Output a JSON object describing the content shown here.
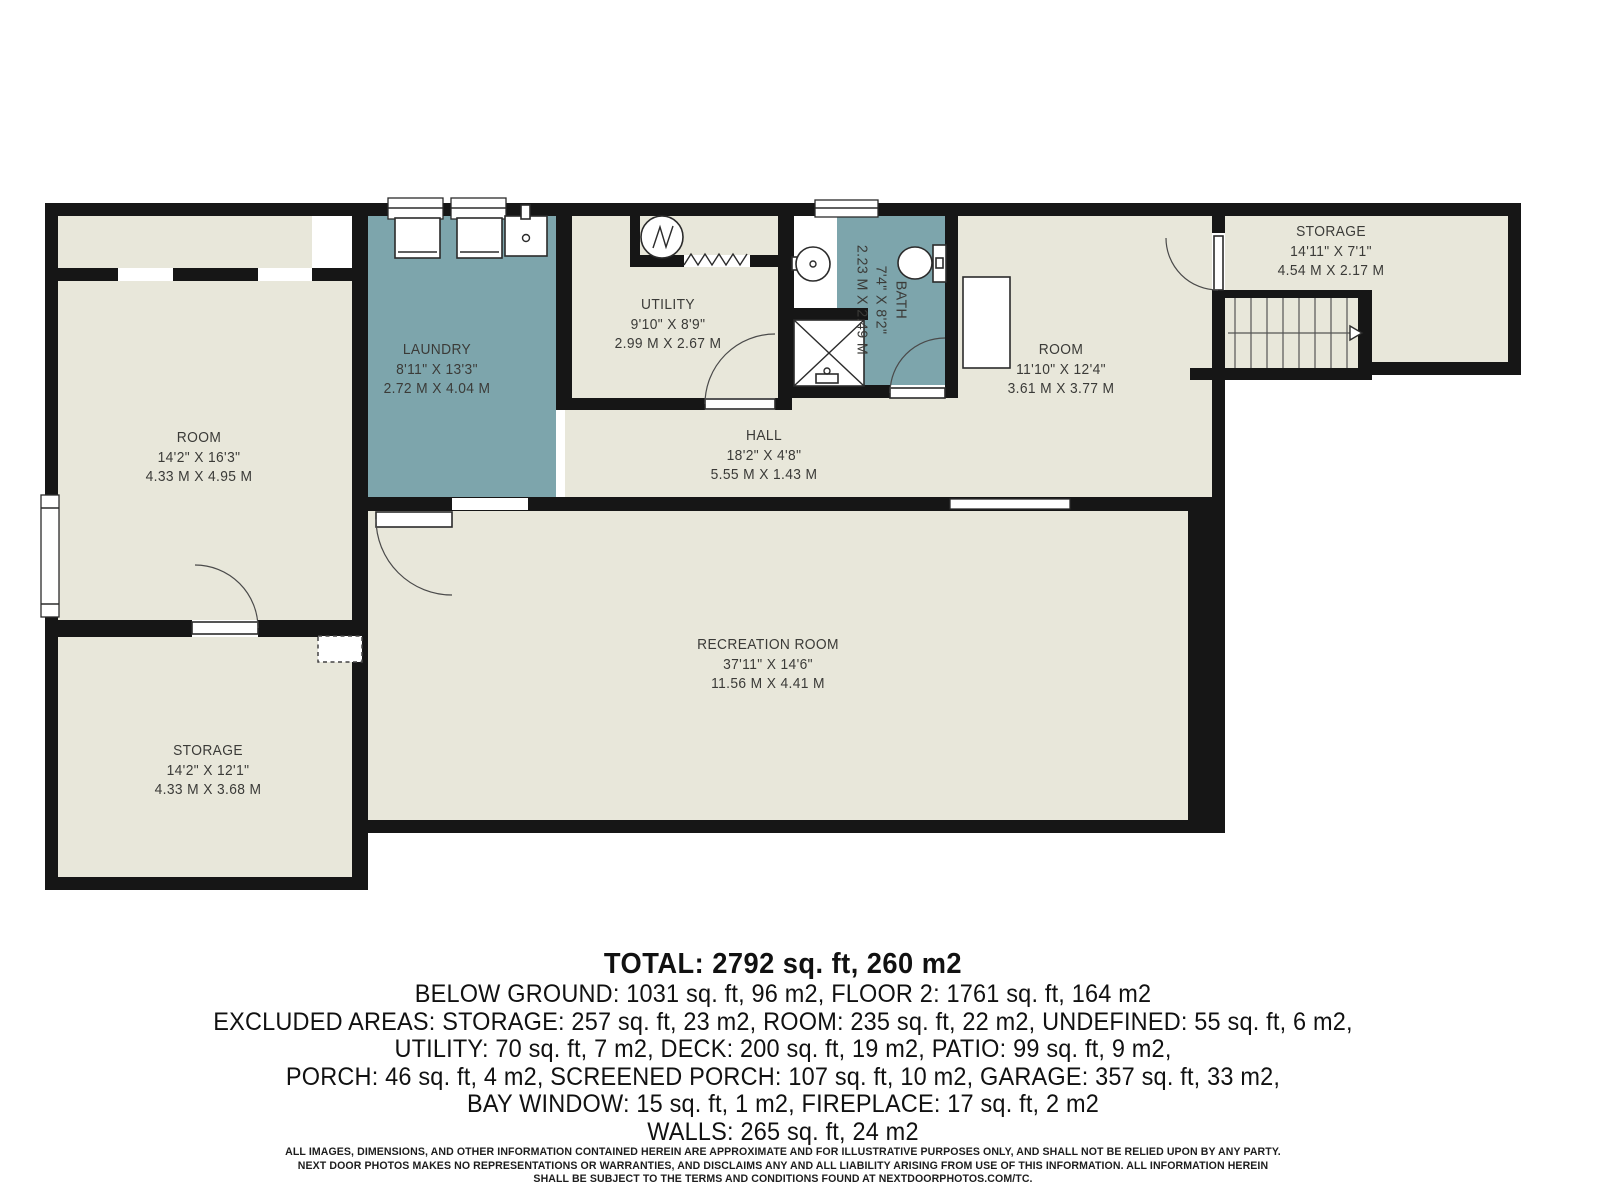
{
  "floor_plan": {
    "colors": {
      "room_fill": "#e8e7da",
      "wet_fill": "#7da5ac",
      "wall": "#161616",
      "label_text": "#3b3b38"
    },
    "rooms": [
      {
        "id": "room-left",
        "name": "ROOM",
        "imperial": "14'2\" X 16'3\"",
        "metric": "4.33 M X 4.95 M"
      },
      {
        "id": "laundry",
        "name": "LAUNDRY",
        "imperial": "8'11\" X 13'3\"",
        "metric": "2.72 M X 4.04 M"
      },
      {
        "id": "utility",
        "name": "UTILITY",
        "imperial": "9'10\" X 8'9\"",
        "metric": "2.99 M X 2.67 M"
      },
      {
        "id": "bath",
        "name": "BATH",
        "imperial": "7'4\" X 8'2\"",
        "metric": "2.23 M X 2.49 M"
      },
      {
        "id": "room-right",
        "name": "ROOM",
        "imperial": "11'10\" X 12'4\"",
        "metric": "3.61 M X 3.77 M"
      },
      {
        "id": "storage-top",
        "name": "STORAGE",
        "imperial": "14'11\" X 7'1\"",
        "metric": "4.54 M X 2.17 M"
      },
      {
        "id": "hall",
        "name": "HALL",
        "imperial": "18'2\" X 4'8\"",
        "metric": "5.55 M X 1.43 M"
      },
      {
        "id": "recreation",
        "name": "RECREATION ROOM",
        "imperial": "37'11\" X 14'6\"",
        "metric": "11.56 M X 4.41 M"
      },
      {
        "id": "storage-bottom",
        "name": "STORAGE",
        "imperial": "14'2\" X 12'1\"",
        "metric": "4.33 M X 3.68 M"
      }
    ],
    "fixtures": [
      "washer",
      "dryer",
      "laundry-sink",
      "furnace",
      "wall-break",
      "bathroom-sink",
      "shower",
      "toilet",
      "closet",
      "crawl-space-opening"
    ],
    "stairs": {
      "direction": "right",
      "treads": 9
    }
  },
  "summary": {
    "total": "TOTAL: 2792 sq. ft, 260 m2",
    "lines": [
      "BELOW GROUND: 1031 sq. ft, 96 m2, FLOOR 2: 1761 sq. ft, 164 m2",
      "EXCLUDED AREAS: STORAGE: 257 sq. ft, 23 m2, ROOM: 235 sq. ft, 22 m2, UNDEFINED: 55 sq. ft, 6 m2,",
      "UTILITY: 70 sq. ft, 7 m2, DECK: 200 sq. ft, 19 m2, PATIO: 99 sq. ft, 9 m2,",
      "PORCH: 46 sq. ft, 4 m2, SCREENED PORCH: 107 sq. ft, 10 m2, GARAGE: 357 sq. ft, 33 m2,",
      "BAY WINDOW: 15 sq. ft, 1 m2, FIREPLACE: 17 sq. ft, 2 m2",
      "WALLS: 265 sq. ft, 24 m2"
    ]
  },
  "disclaimer": {
    "line1": "ALL IMAGES, DIMENSIONS, AND OTHER INFORMATION CONTAINED HEREIN ARE APPROXIMATE AND FOR ILLUSTRATIVE PURPOSES ONLY, AND SHALL NOT BE RELIED UPON BY ANY PARTY.",
    "line2": "NEXT DOOR PHOTOS MAKES NO REPRESENTATIONS OR WARRANTIES, AND DISCLAIMS ANY AND ALL LIABILITY ARISING FROM USE OF THIS INFORMATION. ALL INFORMATION HEREIN",
    "line3": "SHALL BE SUBJECT TO THE TERMS AND CONDITIONS FOUND AT NEXTDOORPHOTOS.COM/TC."
  }
}
